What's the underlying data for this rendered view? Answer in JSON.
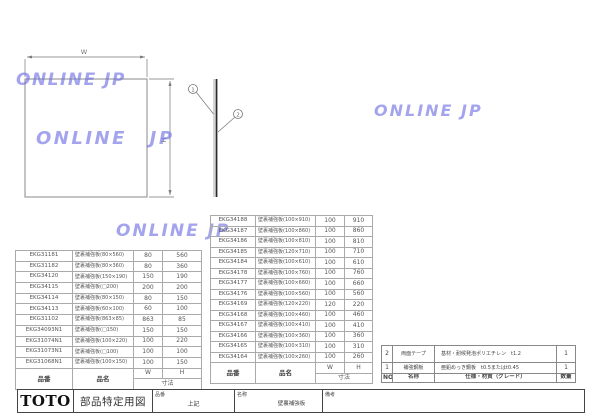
{
  "watermark": {
    "text": "ONLINE JP",
    "color": "#6c6ce4"
  },
  "drawing": {
    "width_label": "W",
    "height_label": "H",
    "callout_1": "1",
    "callout_2": "2"
  },
  "tables": {
    "headers": {
      "part_no": "品番",
      "part_name": "品名",
      "w": "W",
      "h": "H",
      "dim": "寸法"
    },
    "left": {
      "rows": [
        {
          "no": "EKG31181",
          "name": "壁裏補強板(80×560)",
          "w": "80",
          "h": "560"
        },
        {
          "no": "EKG31182",
          "name": "壁裏補強板(80×360)",
          "w": "80",
          "h": "360"
        },
        {
          "no": "EKG34120",
          "name": "壁裏補強板(150×190)",
          "w": "150",
          "h": "190"
        },
        {
          "no": "EKG34115",
          "name": "壁裏補強板(□200)",
          "w": "200",
          "h": "200"
        },
        {
          "no": "EKG34114",
          "name": "壁裏補強板(80×150)",
          "w": "80",
          "h": "150"
        },
        {
          "no": "EKG34113",
          "name": "壁裏補強板(60×100)",
          "w": "60",
          "h": "100"
        },
        {
          "no": "EKG31102",
          "name": "壁裏補強板(863×85)",
          "w": "863",
          "h": "85"
        },
        {
          "no": "EKG34093N1",
          "name": "壁裏補強板(□150)",
          "w": "150",
          "h": "150"
        },
        {
          "no": "EKG31074N1",
          "name": "壁裏補強板(100×220)",
          "w": "100",
          "h": "220"
        },
        {
          "no": "EKG31073N1",
          "name": "壁裏補強板(□100)",
          "w": "100",
          "h": "100"
        },
        {
          "no": "EKG31068N1",
          "name": "壁裏補強板(100×150)",
          "w": "100",
          "h": "150"
        }
      ]
    },
    "middle": {
      "rows": [
        {
          "no": "EKG34188",
          "name": "壁裏補強板(100×910)",
          "w": "100",
          "h": "910"
        },
        {
          "no": "EKG34187",
          "name": "壁裏補強板(100×860)",
          "w": "100",
          "h": "860"
        },
        {
          "no": "EKG34186",
          "name": "壁裏補強板(100×810)",
          "w": "100",
          "h": "810"
        },
        {
          "no": "EKG34185",
          "name": "壁裏補強板(120×710)",
          "w": "100",
          "h": "710"
        },
        {
          "no": "EKG34184",
          "name": "壁裏補強板(100×610)",
          "w": "100",
          "h": "610"
        },
        {
          "no": "EKG34178",
          "name": "壁裏補強板(100×760)",
          "w": "100",
          "h": "760"
        },
        {
          "no": "EKG34177",
          "name": "壁裏補強板(100×660)",
          "w": "100",
          "h": "660"
        },
        {
          "no": "EKG34176",
          "name": "壁裏補強板(100×560)",
          "w": "100",
          "h": "560"
        },
        {
          "no": "EKG34169",
          "name": "壁裏補強板(120×220)",
          "w": "120",
          "h": "220"
        },
        {
          "no": "EKG34168",
          "name": "壁裏補強板(100×460)",
          "w": "100",
          "h": "460"
        },
        {
          "no": "EKG34167",
          "name": "壁裏補強板(100×410)",
          "w": "100",
          "h": "410"
        },
        {
          "no": "EKG34166",
          "name": "壁裏補強板(100×360)",
          "w": "100",
          "h": "360"
        },
        {
          "no": "EKG34165",
          "name": "壁裏補強板(100×310)",
          "w": "100",
          "h": "310"
        },
        {
          "no": "EKG34164",
          "name": "壁裏補強板(100×260)",
          "w": "100",
          "h": "260"
        }
      ]
    }
  },
  "bom": {
    "headers": {
      "no": "NO",
      "name": "名称",
      "spec": "仕様・材質（グレード）",
      "qty": "数量"
    },
    "rows": [
      {
        "no": "2",
        "name": "両面テープ",
        "spec": "基材・耐候発泡ポリエチレン　t1.2",
        "qty": "1"
      },
      {
        "no": "1",
        "name": "補強鋼板",
        "spec": "亜鉛めっき鋼板　t0.5またはt0.45",
        "qty": "1"
      }
    ]
  },
  "title_block": {
    "logo": "TOTO",
    "doc_type": "部品特定用図",
    "part_no_label": "品番",
    "part_no_value": "上記",
    "name_label": "名称",
    "name_value": "壁裏補強板",
    "remarks_label": "備考"
  }
}
